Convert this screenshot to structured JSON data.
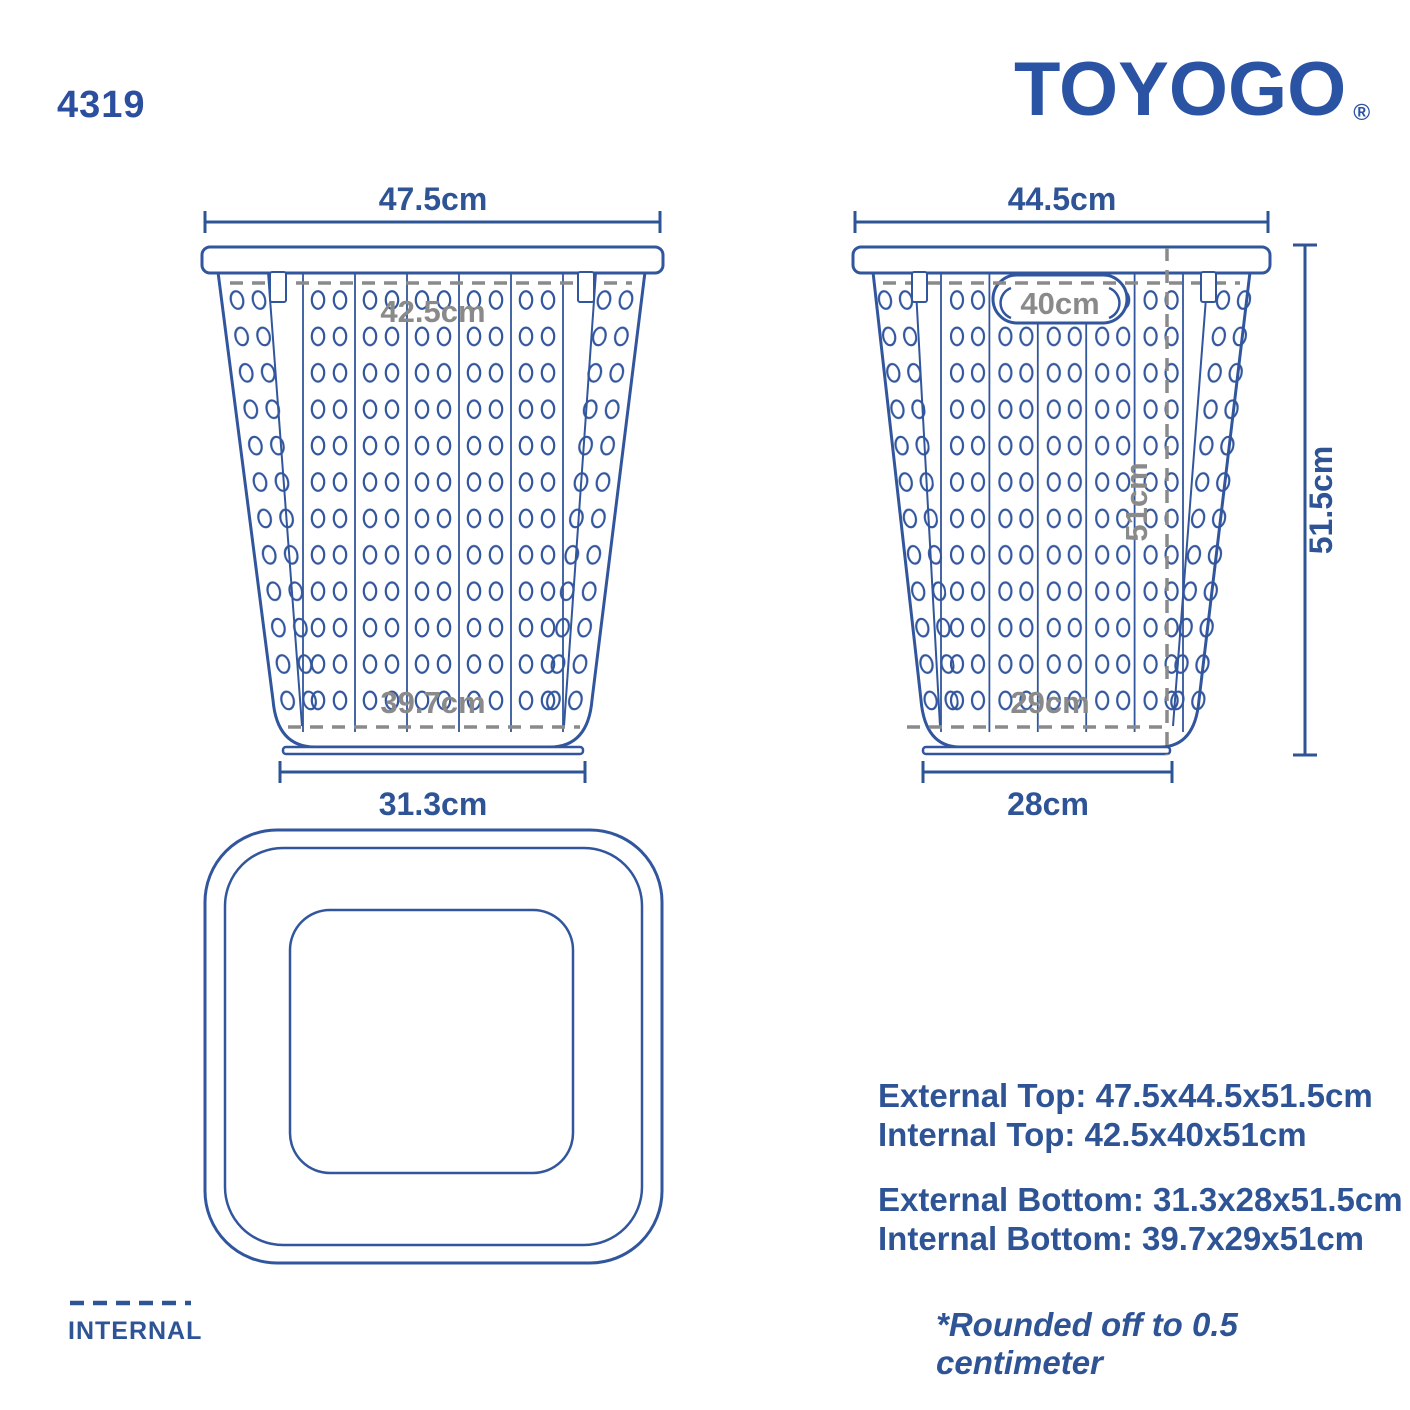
{
  "header": {
    "product_code": "4319",
    "brand": "TOYOGO",
    "registered_mark": "®"
  },
  "front_view": {
    "external_top_width": "47.5cm",
    "internal_top_width": "42.5cm",
    "internal_bottom_width": "39.7cm",
    "external_bottom_width": "31.3cm"
  },
  "side_view": {
    "external_top_depth": "44.5cm",
    "internal_top_depth": "40cm",
    "internal_height": "51cm",
    "external_height": "51.5cm",
    "internal_bottom_depth": "29cm",
    "external_bottom_depth": "28cm"
  },
  "specs": {
    "external_top": "External Top: 47.5x44.5x51.5cm",
    "internal_top": "Internal Top: 42.5x40x51cm",
    "external_bottom": "External Bottom: 31.3x28x51.5cm",
    "internal_bottom": "Internal Bottom: 39.7x29x51cm"
  },
  "legend": {
    "internal": "INTERNAL"
  },
  "footnote": "*Rounded off to 0.5 centimeter",
  "colors": {
    "line_blue": "#32569d",
    "text_blue": "#2e5496",
    "logo_blue": "#2b53a4",
    "dash_gray": "#8a8a8a"
  }
}
